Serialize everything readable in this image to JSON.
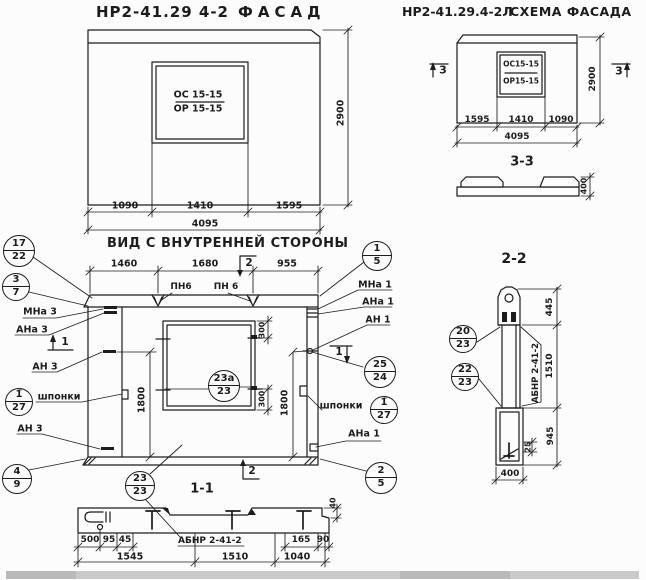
{
  "colors": {
    "ink": "#1c1c1c",
    "paper": "#fcfcfc",
    "scan_strip": "#c9c9c9"
  },
  "facade": {
    "title_code": "НР2-41.29 4-2",
    "title_word": "ФАСАД",
    "window_top": "ОС 15-15",
    "window_bottom": "ОР 15-15",
    "dims": {
      "d1": "1090",
      "d2": "1410",
      "d3": "1595",
      "total": "4095",
      "height": "2900"
    }
  },
  "schema": {
    "title_code": "НР2-41.29.4-2Л",
    "title_word": "СХЕМА ФАСАДА",
    "window_top": "ОС15-15",
    "window_bottom": "ОР15-15",
    "dims": {
      "d1": "1595",
      "d2": "1410",
      "d3": "1090",
      "total": "4095",
      "height": "2900"
    },
    "marker": "3",
    "section_title": "3-3",
    "profile_depth": "400"
  },
  "inner": {
    "title": "ВИД С ВНУТРЕННЕЙ СТОРОНЫ",
    "dims": {
      "t1": "1460",
      "t2": "1680",
      "t3": "955",
      "left": "1800",
      "right": "1800",
      "w1": "300",
      "w2": "300"
    },
    "labels": {
      "mna3": "МНа 3",
      "ana3": "АНа 3",
      "an3a": "АН 3",
      "shponki_l": "шпонки",
      "an3b": "АН 3",
      "mna1": "МНа 1",
      "ana1": "АНа 1",
      "an1": "АН 1",
      "shponki_r": "шпонки",
      "ana1b": "АНа 1",
      "pn6a": "ПН6",
      "pn6b": "ПН 6"
    },
    "flags": {
      "s1": "1",
      "s2": "2"
    }
  },
  "section11": {
    "title": "1-1",
    "rebar_label": "АБНР 2-41-2",
    "dims": {
      "a": "500",
      "b": "95",
      "c": "45",
      "d": "165",
      "e": "90",
      "f": "40",
      "g": "1545",
      "h": "1510",
      "i": "1040"
    }
  },
  "section22": {
    "title": "2-2",
    "rebar_label": "АБНР 2-41-2",
    "dims": {
      "a": "445",
      "b": "1510",
      "c": "945",
      "d": "25",
      "e": "400"
    }
  },
  "callouts": {
    "c17_22": {
      "top": "17",
      "bottom": "22"
    },
    "c3_7": {
      "top": "3",
      "bottom": "7"
    },
    "c1u_27": {
      "top": "1̈",
      "bottom": "27"
    },
    "c4_9": {
      "top": "4",
      "bottom": "9"
    },
    "c1_5": {
      "top": "1",
      "bottom": "5"
    },
    "c25_24": {
      "top": "25",
      "bottom": "24"
    },
    "c1m_27": {
      "top": "1̄",
      "bottom": "27"
    },
    "c2_5": {
      "top": "2",
      "bottom": "5"
    },
    "c23a_23": {
      "top": "23а",
      "bottom": "23"
    },
    "c23_23": {
      "top": "23",
      "bottom": "23"
    },
    "c20_23": {
      "top": "20",
      "bottom": "23"
    },
    "c22_23": {
      "top": "22",
      "bottom": "23"
    }
  }
}
